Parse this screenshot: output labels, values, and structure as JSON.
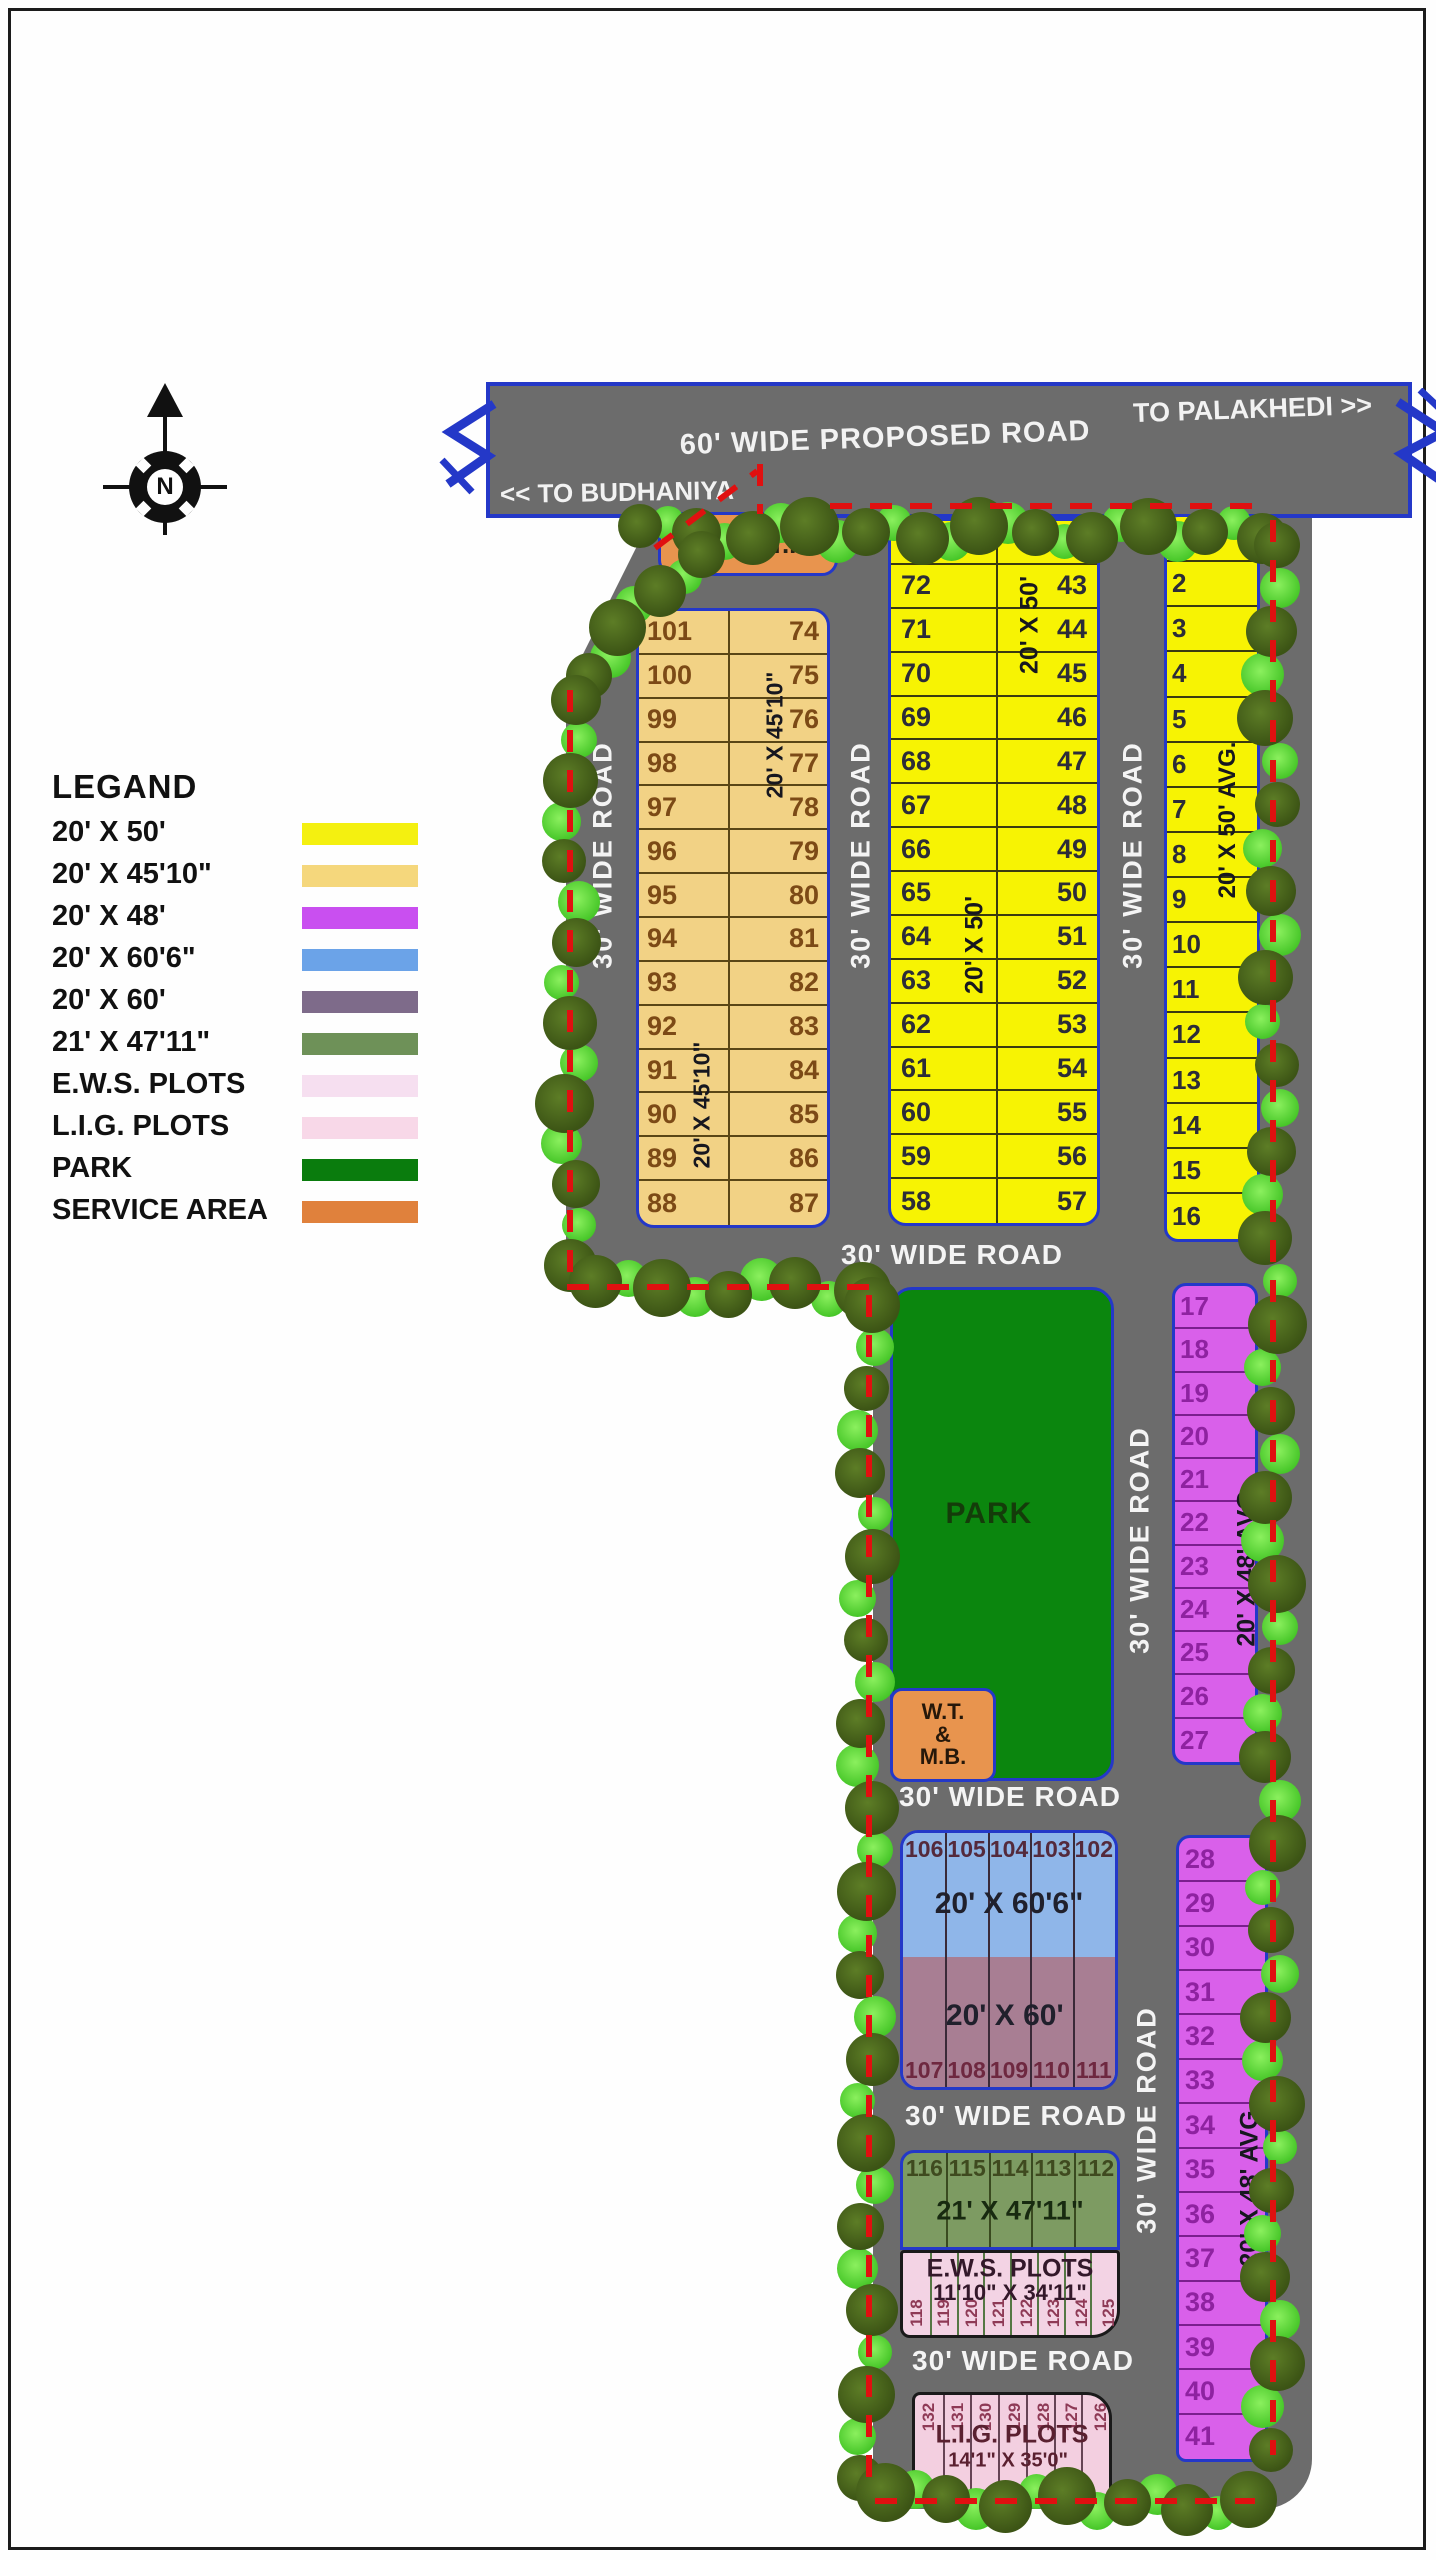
{
  "compass": {
    "letter": "N"
  },
  "legend": {
    "title": "LEGAND",
    "items": [
      {
        "label": "20' X 50'",
        "color": "#f4f010"
      },
      {
        "label": "20' X 45'10\"",
        "color": "#f5d77c"
      },
      {
        "label": "20' X 48'",
        "color": "#c94ff0"
      },
      {
        "label": "20' X 60'6\"",
        "color": "#6ba3e8"
      },
      {
        "label": "20' X 60'",
        "color": "#7e6b8a"
      },
      {
        "label": "21' X 47'11\"",
        "color": "#6e9158"
      },
      {
        "label": "E.W.S. PLOTS",
        "color": "#f6dff0"
      },
      {
        "label": "L.I.G. PLOTS",
        "color": "#f8d8e8"
      },
      {
        "label": "PARK",
        "color": "#0a7c0d"
      },
      {
        "label": "SERVICE AREA",
        "color": "#e0813c"
      }
    ]
  },
  "top_road": {
    "name": "60' WIDE PROPOSED ROAD",
    "right_dest": "TO PALAKHEDI >>",
    "left_dest": "<< TO BUDHANIYA"
  },
  "road_label": "30' WIDE ROAD",
  "facilities": {
    "stf": "S.T. & T.F",
    "park": "PARK",
    "wtmb_lines": [
      "W.T.",
      "&",
      "M.B."
    ]
  },
  "blocks": {
    "khaki": {
      "size": "20' X 45'10\"",
      "left_col": [
        "101",
        "100",
        "99",
        "98",
        "97",
        "96",
        "95",
        "94",
        "93",
        "92",
        "91",
        "90",
        "89",
        "88"
      ],
      "right_col": [
        "74",
        "75",
        "76",
        "77",
        "78",
        "79",
        "80",
        "81",
        "82",
        "83",
        "84",
        "85",
        "86",
        "87"
      ]
    },
    "yellow": {
      "size": "20' X 50'",
      "left_col": [
        "73",
        "72",
        "71",
        "70",
        "69",
        "68",
        "67",
        "66",
        "65",
        "64",
        "63",
        "62",
        "61",
        "60",
        "59",
        "58"
      ],
      "right_col": [
        "42",
        "43",
        "44",
        "45",
        "46",
        "47",
        "48",
        "49",
        "50",
        "51",
        "52",
        "53",
        "54",
        "55",
        "56",
        "57"
      ]
    },
    "east": {
      "size": "20' X 50' AVG.",
      "plots": [
        "1",
        "2",
        "3",
        "4",
        "5",
        "6",
        "7",
        "8",
        "9",
        "10",
        "11",
        "12",
        "13",
        "14",
        "15",
        "16"
      ]
    },
    "purple_a": {
      "size": "20' X 48' AVG.",
      "plots": [
        "17",
        "18",
        "19",
        "20",
        "21",
        "22",
        "23",
        "24",
        "25",
        "26",
        "27"
      ]
    },
    "purple_b": {
      "size": "20' X 48' AVG.",
      "plots": [
        "28",
        "29",
        "30",
        "31",
        "32",
        "33",
        "34",
        "35",
        "36",
        "37",
        "38",
        "39",
        "40",
        "41"
      ]
    },
    "blue": {
      "size": "20' X 60'6\"",
      "plots": [
        "106",
        "105",
        "104",
        "103",
        "102"
      ]
    },
    "mauve": {
      "size": "20' X 60'",
      "plots": [
        "107",
        "108",
        "109",
        "110",
        "111"
      ]
    },
    "green": {
      "size": "21' X 47'11\"",
      "plots": [
        "116",
        "115",
        "114",
        "113",
        "112"
      ]
    },
    "ews": {
      "title": "E.W.S. PLOTS",
      "size": "11'10\" X 34'11\"",
      "plots": [
        "118",
        "119",
        "120",
        "121",
        "122",
        "123",
        "124",
        "125"
      ]
    },
    "lig": {
      "title": "L.I.G. PLOTS",
      "size": "14'1\" X 35'0\"",
      "plots": [
        "132",
        "131",
        "130",
        "129",
        "128",
        "127",
        "126"
      ]
    }
  }
}
